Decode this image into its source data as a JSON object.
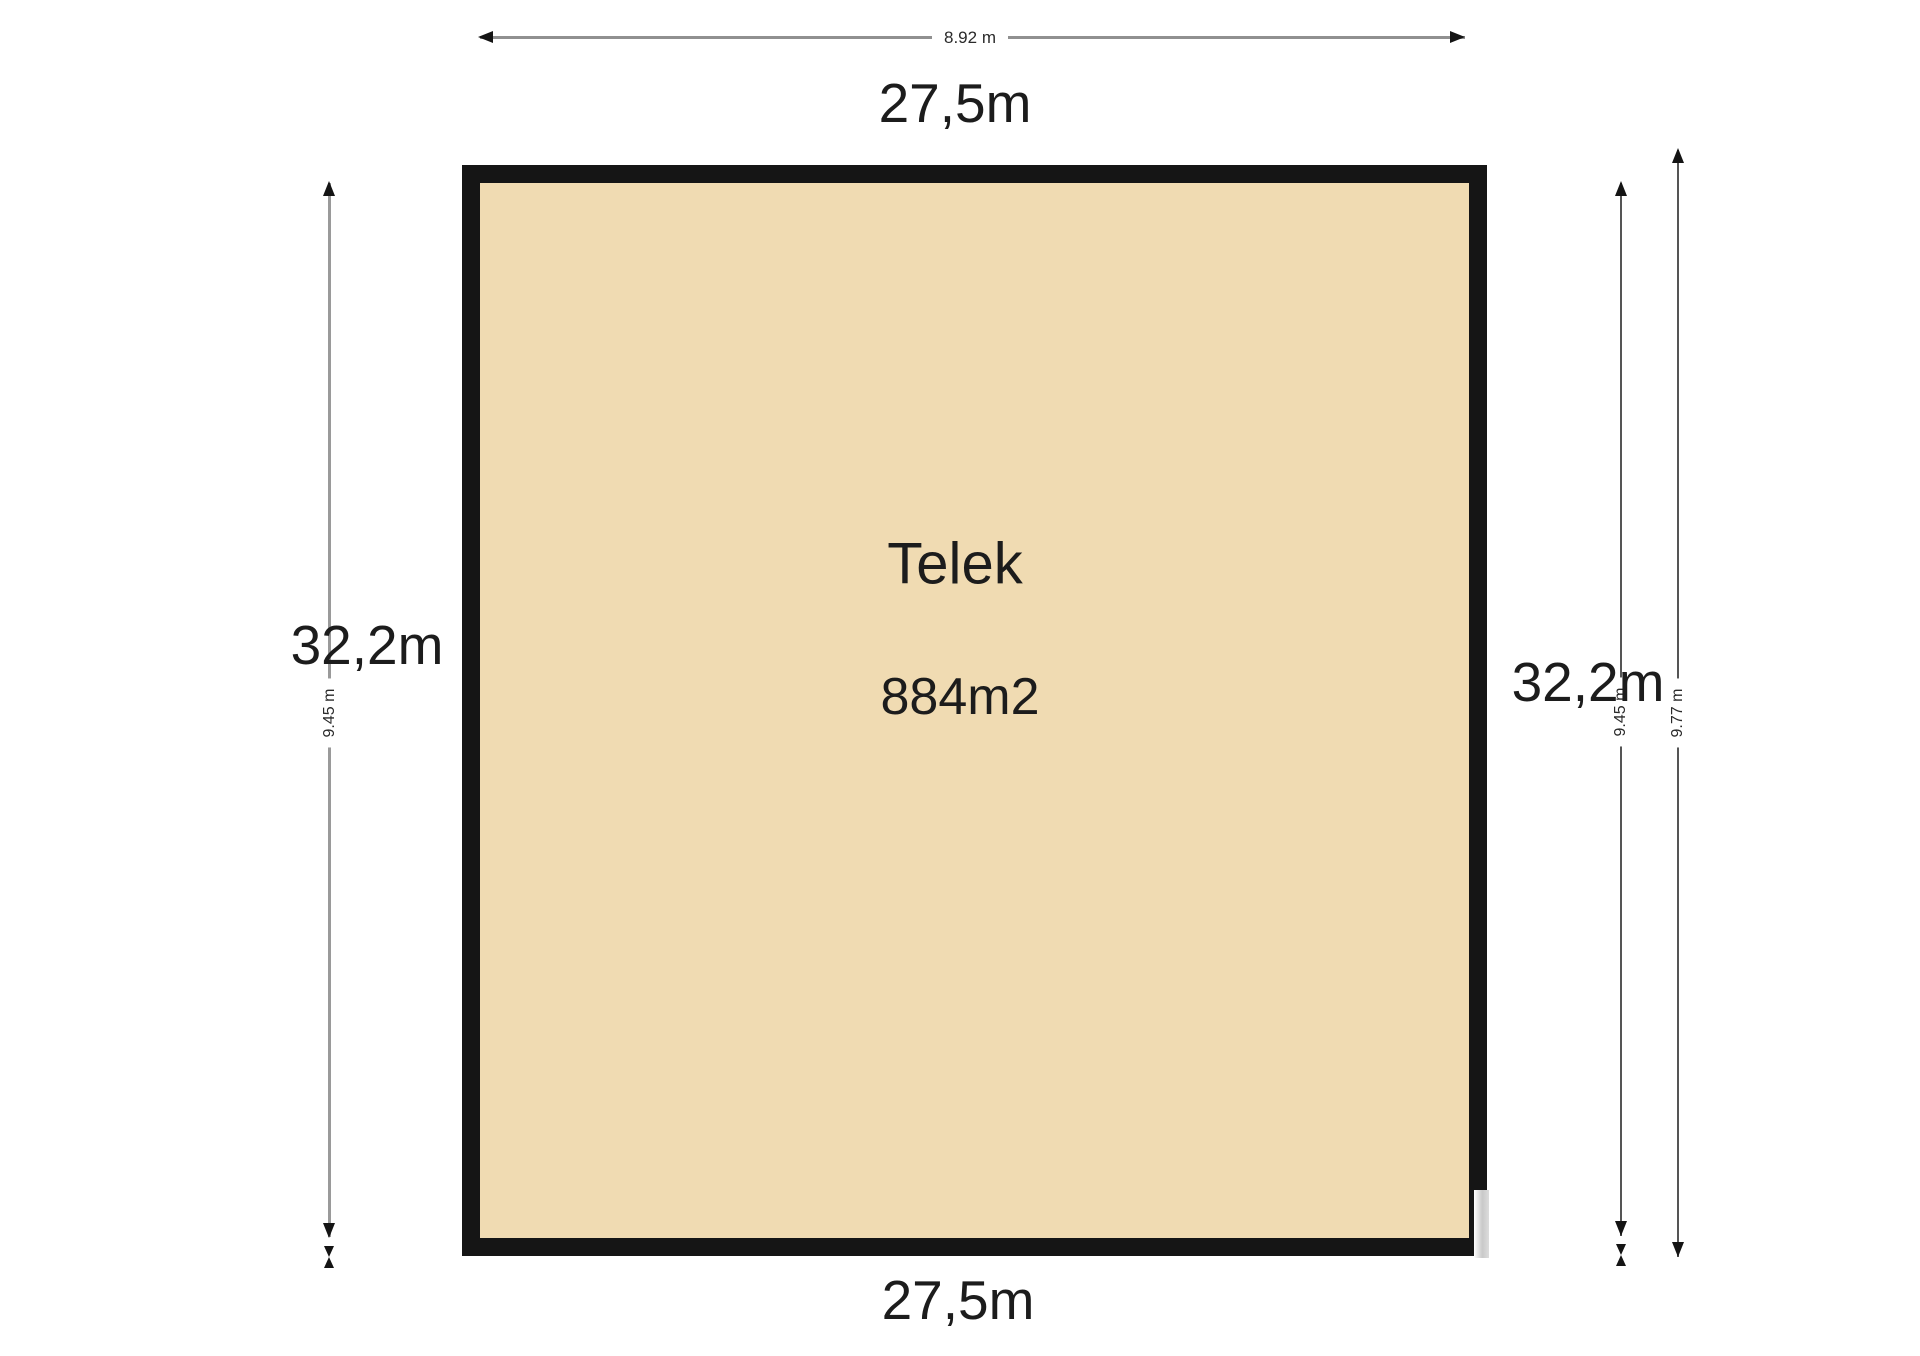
{
  "plot": {
    "name": "Telek",
    "area": "884m2"
  },
  "dimensions": {
    "top_segment": "8.92 m",
    "width_top": "27,5m",
    "width_bottom": "27,5m",
    "height_left": "32,2m",
    "height_right": "32,2m",
    "left_sub_segment": "9.45 m",
    "right_inner_sub_segment": "9.45 m",
    "right_outer_sub_segment": "9.77 m"
  },
  "colors": {
    "parcel_fill": "#f0dbb2",
    "parcel_border": "#151515",
    "dimension_line_gray": "#9a9a9a",
    "dimension_line_dark": "#555555",
    "text": "#1c1c1c",
    "background": "#ffffff"
  }
}
